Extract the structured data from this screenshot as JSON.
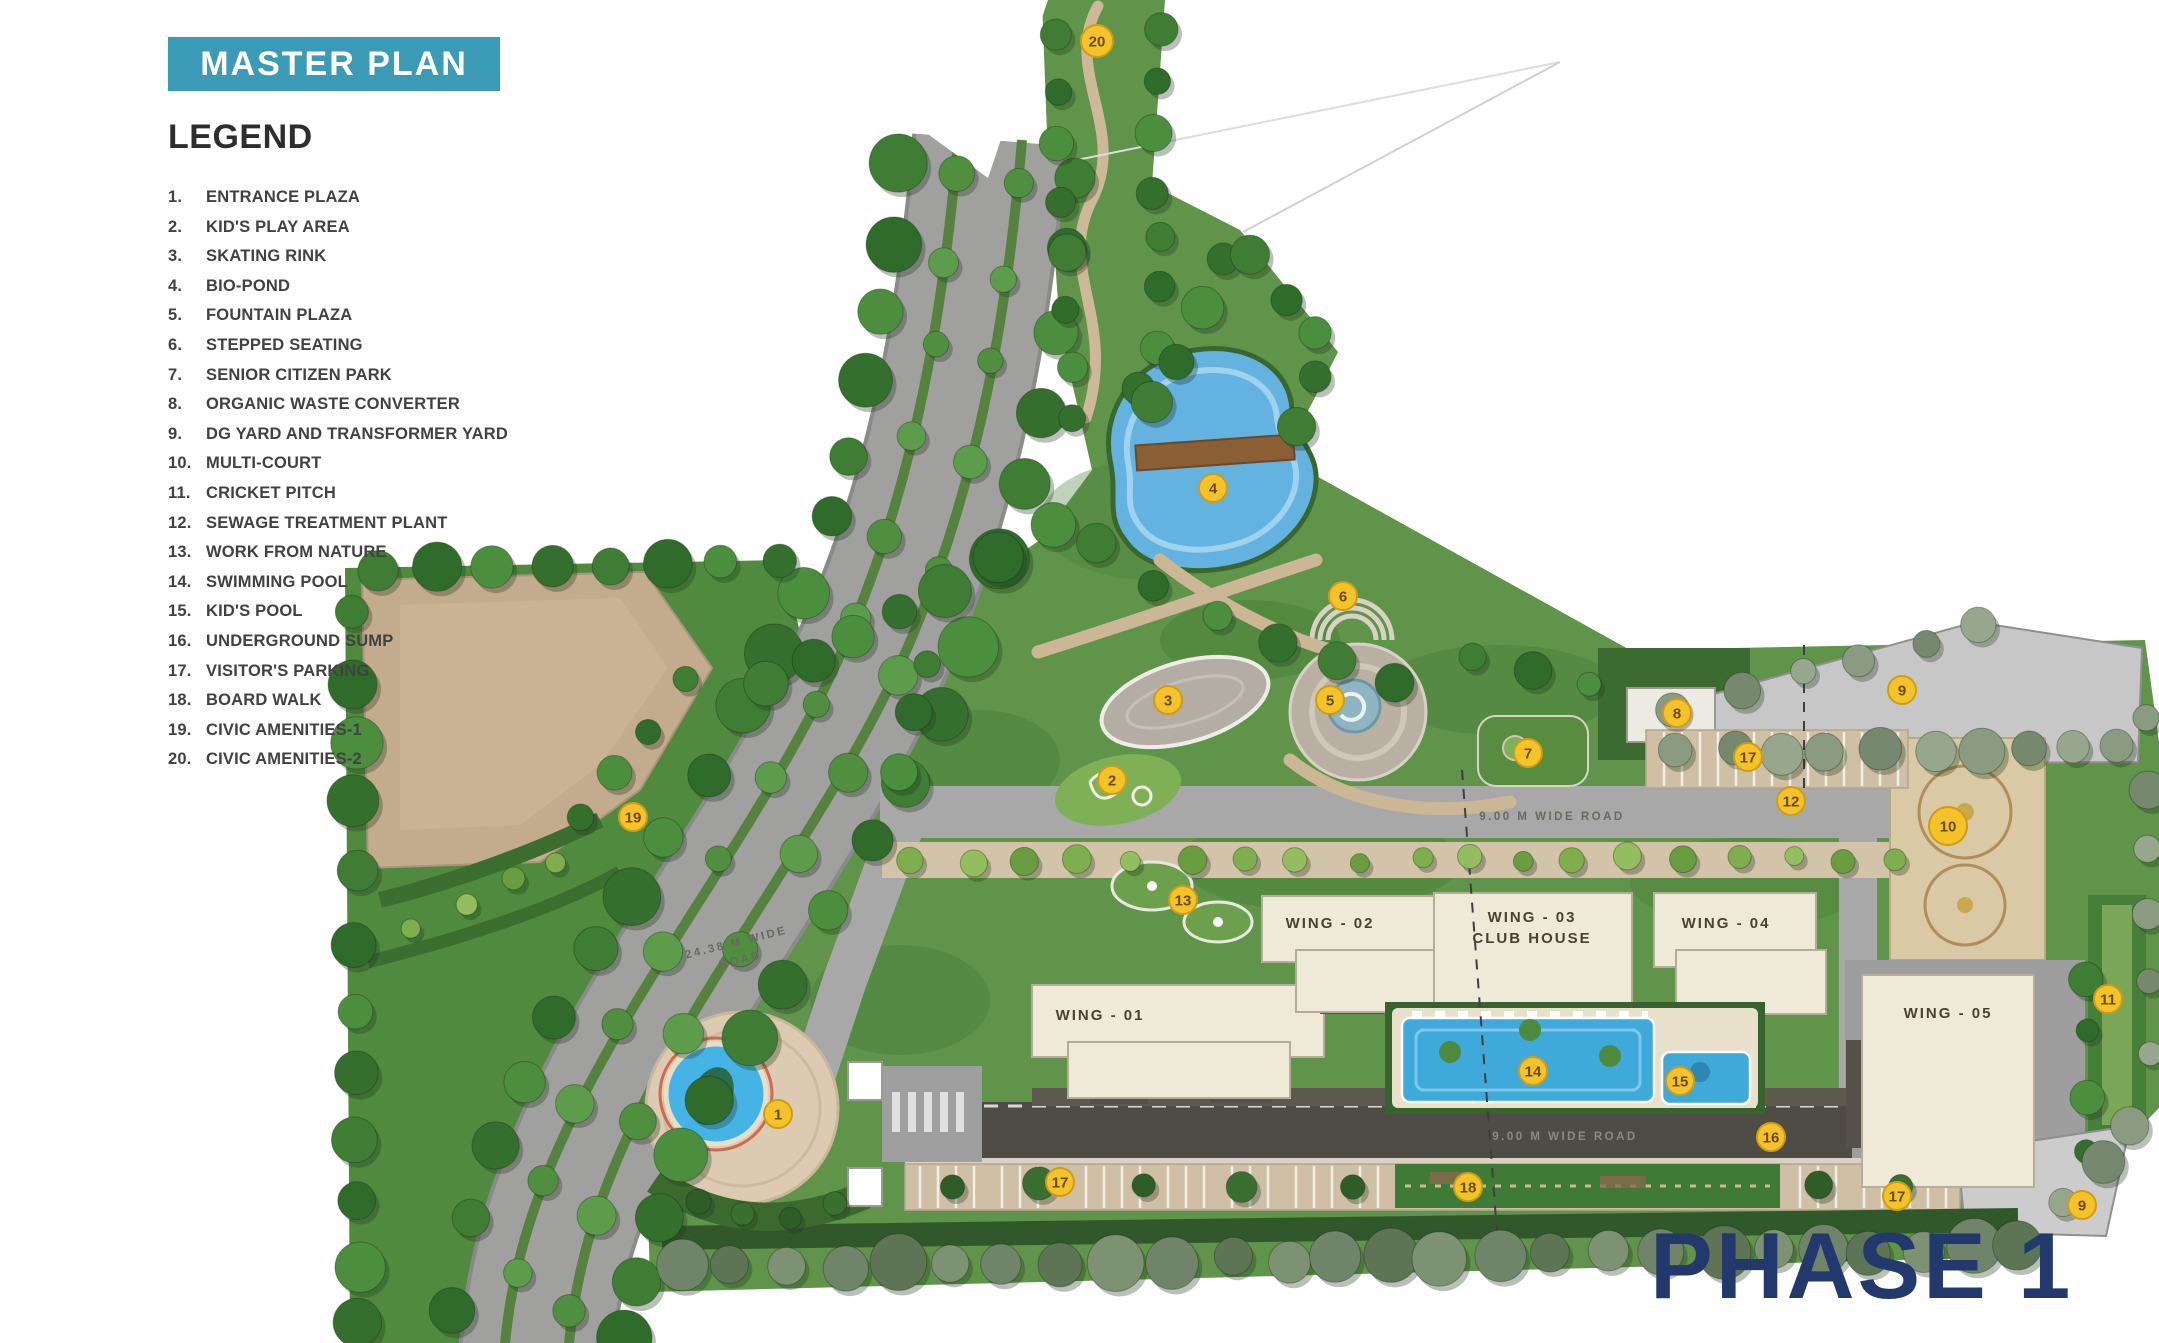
{
  "banner": {
    "title": "MASTER PLAN"
  },
  "legend": {
    "heading": "LEGEND",
    "items": [
      {
        "n": "1.",
        "label": "ENTRANCE PLAZA"
      },
      {
        "n": "2.",
        "label": "KID'S PLAY AREA"
      },
      {
        "n": "3.",
        "label": "SKATING RINK"
      },
      {
        "n": "4.",
        "label": "BIO-POND"
      },
      {
        "n": "5.",
        "label": "FOUNTAIN PLAZA"
      },
      {
        "n": "6.",
        "label": "STEPPED SEATING"
      },
      {
        "n": "7.",
        "label": "SENIOR CITIZEN PARK"
      },
      {
        "n": "8.",
        "label": "ORGANIC WASTE CONVERTER"
      },
      {
        "n": "9.",
        "label": "DG YARD AND TRANSFORMER YARD"
      },
      {
        "n": "10.",
        "label": "MULTI-COURT"
      },
      {
        "n": "11.",
        "label": "CRICKET PITCH"
      },
      {
        "n": "12.",
        "label": "SEWAGE TREATMENT PLANT"
      },
      {
        "n": "13.",
        "label": "WORK FROM NATURE"
      },
      {
        "n": "14.",
        "label": "SWIMMING POOL"
      },
      {
        "n": "15.",
        "label": "KID'S POOL"
      },
      {
        "n": "16.",
        "label": "UNDERGROUND SUMP"
      },
      {
        "n": "17.",
        "label": "VISITOR'S PARKING"
      },
      {
        "n": "18.",
        "label": "BOARD WALK"
      },
      {
        "n": "19.",
        "label": "CIVIC AMENITIES-1"
      },
      {
        "n": "20.",
        "label": "CIVIC AMENITIES-2"
      }
    ]
  },
  "phase_label": "PHASE 1",
  "map": {
    "wings": [
      {
        "label": "WING - 01",
        "x": 1100,
        "y": 1020
      },
      {
        "label": "WING - 02",
        "x": 1330,
        "y": 928
      },
      {
        "label": "WING - 03",
        "label2": "CLUB HOUSE",
        "x": 1532,
        "y": 922
      },
      {
        "label": "WING - 04",
        "x": 1726,
        "y": 928
      },
      {
        "label": "WING - 05",
        "x": 1948,
        "y": 1018
      }
    ],
    "road_labels": [
      {
        "line1": "24.38 M WIDE",
        "line2": "ROAD",
        "x": 737,
        "y": 946,
        "rot": -14,
        "on_dark": false
      },
      {
        "line1": "9.00 M WIDE ROAD",
        "x": 1552,
        "y": 820,
        "rot": 0,
        "on_dark": false
      },
      {
        "line1": "9.00 M WIDE ROAD",
        "x": 1565,
        "y": 1140,
        "rot": 0,
        "on_dark": true
      }
    ],
    "markers": [
      {
        "n": 1,
        "x": 778,
        "y": 1114
      },
      {
        "n": 2,
        "x": 1112,
        "y": 780
      },
      {
        "n": 3,
        "x": 1168,
        "y": 700
      },
      {
        "n": 4,
        "x": 1213,
        "y": 488
      },
      {
        "n": 5,
        "x": 1330,
        "y": 700
      },
      {
        "n": 6,
        "x": 1343,
        "y": 596
      },
      {
        "n": 7,
        "x": 1528,
        "y": 753
      },
      {
        "n": 8,
        "x": 1677,
        "y": 713
      },
      {
        "n": 9,
        "x": 1902,
        "y": 690
      },
      {
        "n": 9,
        "x": 2082,
        "y": 1205
      },
      {
        "n": 10,
        "x": 1948,
        "y": 826,
        "r": 19
      },
      {
        "n": 11,
        "x": 2108,
        "y": 999
      },
      {
        "n": 12,
        "x": 1791,
        "y": 801
      },
      {
        "n": 13,
        "x": 1183,
        "y": 900
      },
      {
        "n": 14,
        "x": 1533,
        "y": 1071
      },
      {
        "n": 15,
        "x": 1680,
        "y": 1081
      },
      {
        "n": 16,
        "x": 1771,
        "y": 1137
      },
      {
        "n": 17,
        "x": 1748,
        "y": 757
      },
      {
        "n": 17,
        "x": 1060,
        "y": 1182
      },
      {
        "n": 17,
        "x": 1897,
        "y": 1196
      },
      {
        "n": 18,
        "x": 1468,
        "y": 1187
      },
      {
        "n": 19,
        "x": 633,
        "y": 817
      },
      {
        "n": 20,
        "x": 1097,
        "y": 41,
        "r": 16
      }
    ]
  },
  "colors": {
    "banner_bg": "#3b9ab6",
    "banner_text": "#ffffff",
    "legend_text": "#414141",
    "phase_text": "#23396d",
    "marker_fill": "#f4c32a",
    "marker_stroke": "#cf9d15",
    "marker_text": "#6b4a10"
  }
}
